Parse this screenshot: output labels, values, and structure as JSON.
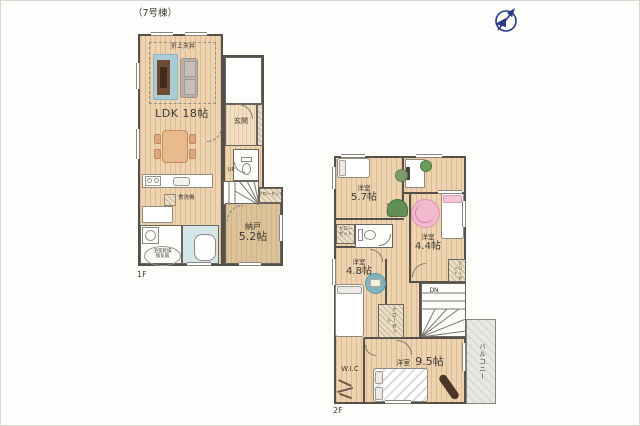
{
  "header": {
    "title": "（7号棟）",
    "compass": "north-compass"
  },
  "f1": {
    "floor": "1F",
    "ldk": "LDK 18帖",
    "ceiling": "折上天井",
    "genkan": "玄関",
    "nando_name": "納戸",
    "nando_size": "5.2帖",
    "closet": "クローゼット",
    "dishwasher": "食洗機",
    "bath_fan1": "浴室乾燥",
    "bath_fan2": "換気扇",
    "up": "UP"
  },
  "f2": {
    "floor": "2F",
    "r57_name": "洋室",
    "r57_size": "5.7帖",
    "r44_name": "洋室",
    "r44_size": "4.4帖",
    "r48_name": "洋室",
    "r48_size": "4.8帖",
    "r95_name": "洋室",
    "r95_size": "9.5帖",
    "wic": "W.I.C",
    "closet_left1": "クロー",
    "closet_left2": "ゼット",
    "closet_mid": "クローゼット",
    "closet_small": "クローゼット",
    "balcony": "バルコニー",
    "dn": "DN"
  },
  "colors": {
    "wall": "#55504a",
    "wood_floor": "#eed3b0",
    "storage_floor": "#dbc298",
    "bath": "#d5e6ea",
    "balcony": "#e7e7e3",
    "rug_blue": "#aaccd6",
    "rug_pink": "#f3bacf",
    "rug_teal": "#7fb3bd",
    "compass_navy": "#2b3a86",
    "accent_green": "#7d9e6b"
  }
}
